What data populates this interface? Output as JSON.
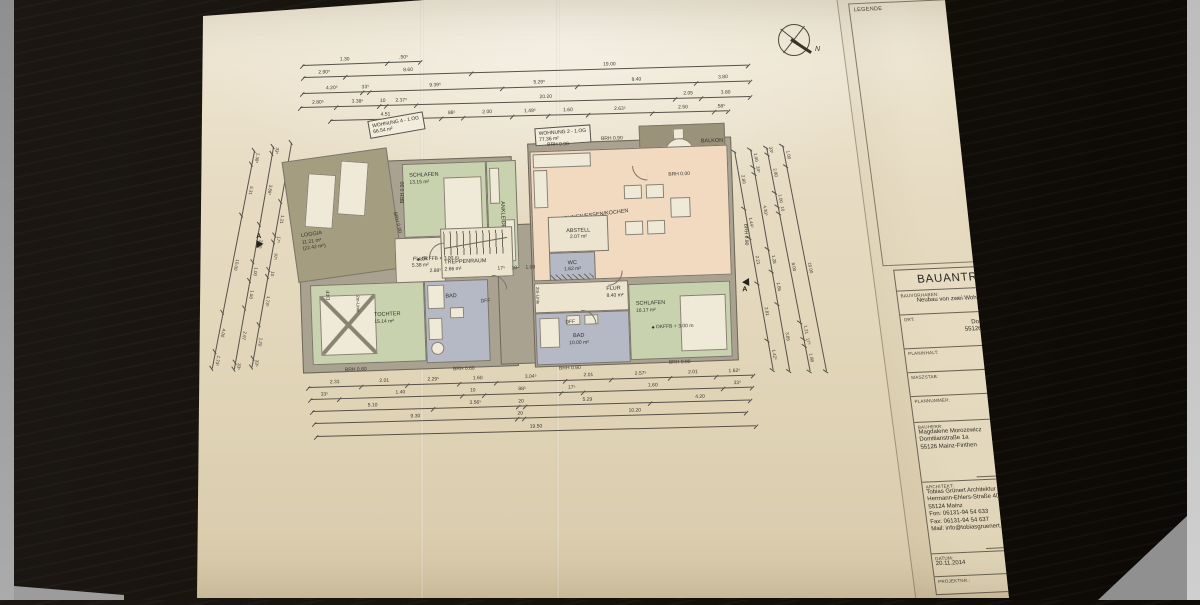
{
  "frame": {
    "legende_label": "LEGENDE"
  },
  "north_label": "N",
  "plan": {
    "apartment_labels": [
      {
        "line1": "WOHNUNG 4 - 1.OG",
        "line2": "66.54 m²"
      },
      {
        "line1": "WOHNUNG 2 - 1.OG",
        "line2": "77.36 m²"
      }
    ],
    "rooms": [
      {
        "name": "LOGGIA",
        "area": "11.21 m²",
        "area2": "(22.42 m²)"
      },
      {
        "name": "SCHLAFEN",
        "area": "13.15 m²"
      },
      {
        "name": "ANKLEIDE",
        "area": ""
      },
      {
        "name": "FLUR",
        "area": "5.38 m²"
      },
      {
        "name": "TOCHTER",
        "area": "15.14 m²"
      },
      {
        "name": "BAD",
        "area": ""
      },
      {
        "name": "TREPPENRAUM",
        "area": "2.66 m²"
      },
      {
        "name": "ABSTELL",
        "area": "2.07 m²"
      },
      {
        "name": "WC",
        "area": "1.62 m²"
      },
      {
        "name": "FLUR",
        "area": "8.40 m²"
      },
      {
        "name": "BAD",
        "area": "10.00 m²"
      },
      {
        "name": "SCHLAFEN",
        "area": "16.17 m²"
      },
      {
        "name": "WOHNEN/ESSEN/KOCHEN",
        "area": "33.78 m²"
      },
      {
        "name": "BALKON",
        "area": "5.32 m²",
        "area2": "(10.64 m²)"
      }
    ],
    "markers": {
      "brh090": "BRH 0.90",
      "brh060": "BRH 0.60",
      "brh000": "BRH 0.00",
      "okffb": "OKFFB + 3.00 m",
      "dff": "DFF",
      "zweim": "2m-Linie",
      "section": "A"
    },
    "inner_dims": [
      "2.88⁵",
      "17⁵",
      "10",
      "1.00"
    ]
  },
  "dims": {
    "top": [
      [
        "1.30",
        ".50⁵"
      ],
      [
        "2.90⁵",
        "8.60",
        "19.00"
      ],
      [
        "4.20⁵",
        "33⁵",
        "9.39⁵",
        "5.29⁵",
        "8.40",
        "3.80"
      ],
      [
        "2.80⁵",
        "3.38⁵",
        "10",
        "2.37⁵",
        "20.20",
        "2.05",
        "3.80"
      ],
      [
        "4.51",
        "88⁵",
        "2.00",
        "1.49⁵",
        "1.60",
        "2.63⁵",
        "2.50",
        ".58⁵"
      ]
    ],
    "bottom": [
      [
        "2.33",
        "2.01",
        "2.29⁵",
        "1.60",
        "3.04⁵",
        "2.01",
        "2.57⁵",
        "2.01",
        "1.62⁵"
      ],
      [
        "33⁵",
        "1.40",
        "10",
        "88⁵",
        "17⁵",
        "1.60",
        "33⁵"
      ],
      [
        "5.10",
        "3.56⁵",
        "20",
        "5.29",
        "4.20"
      ],
      [
        "9.30",
        "20",
        "10.20"
      ],
      [
        "19.50"
      ]
    ],
    "left": [
      [
        "1.38⁵",
        "5.31",
        "10.00",
        "4.00",
        "1.73⁵"
      ],
      [
        "33⁵",
        "3.88⁵",
        "2.00",
        "1.00",
        "1.50",
        "2.97",
        "33⁵"
      ],
      [
        "2.13⁵",
        "1.21",
        "17⁵",
        "97⁵",
        "10",
        "1.73⁵",
        "1.20",
        "33⁵"
      ]
    ],
    "right": [
      [
        "2.80",
        "1.44⁵",
        "2.21",
        "2.81",
        "1.42⁵"
      ],
      [
        "1.00",
        "33⁵",
        "4.30⁵",
        "1.28",
        "1.85",
        "3.85"
      ],
      [
        "33⁵",
        "2.80",
        "1.00",
        "10",
        "8.00",
        "1.21",
        "17⁵",
        "1.88"
      ],
      [
        "1.00",
        "10.00"
      ]
    ]
  },
  "titleblock": {
    "title": "BAUANTRAG",
    "bauvorhaben_label": "BAUVORHABEN:",
    "bauvorhaben": "Neubau von zwei Wohnhäusern",
    "ort_label": "ORT:",
    "ort1": "Domitianstraße 1a",
    "ort2": "55126 Mainz-Finthen",
    "planinhalt_label": "PLANINHALT:",
    "planinhalt": "Grundriss 1.OG",
    "massstab_label": "MASZSTAB:",
    "massstab": "1:100",
    "plannummer_label": "PLANNUMMER:",
    "plannummer": "3",
    "bauherr_label": "BAUHERR:",
    "bauherr1": "Magdalene Morozewicz",
    "bauherr2": "Domitianstraße 1a",
    "bauherr3": "55126 Mainz-Finthen",
    "unterschrift": "Unterschrift",
    "architekt_label": "ARCHITEKT:",
    "architekt1": "Tobias Grünert Architektur",
    "architekt2": "Hermann-Ehlers-Straße 40",
    "architekt3": "55124 Mainz",
    "architekt4": "Fon: 06131-94 54 633",
    "architekt5": "Fax: 06131-94 54 637",
    "architekt6": "Mail: info@tobiasgruenert.de",
    "unterschrift2": "Unterschrift",
    "datum_label": "DATUM:",
    "datum": "20.11.2014",
    "gez_label": "GEZ.:",
    "gez": "SH",
    "projektnr_label": "PROJEKTNR.:"
  }
}
